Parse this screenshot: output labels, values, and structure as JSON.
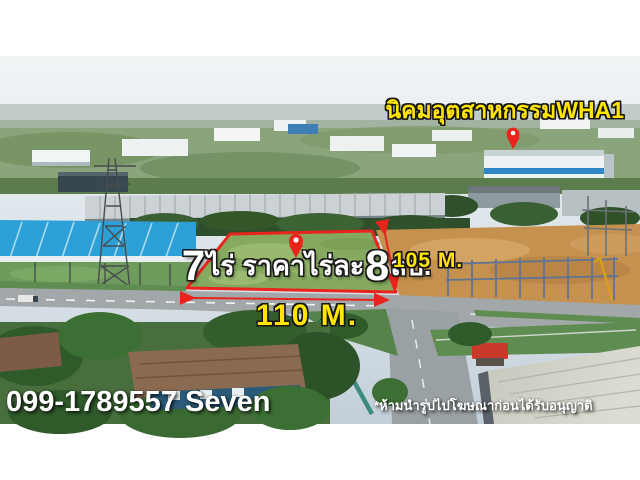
{
  "overlay": {
    "estate_label": "นิคมอุตสาหกรรมWHA1",
    "plot": {
      "area_number": "7",
      "area_text": "ไร่ ราคาไร่ละ",
      "price_number": "8",
      "price_suffix": "ลบ."
    },
    "frontage_width": "110 M.",
    "side_depth": "105 M.",
    "phone": "099-1789557 Seven",
    "disclaimer": "*ห้ามนำรูปไปโฆษณาก่อนได้รับอนุญาติ"
  },
  "icons": {
    "plot_pin": "map-pin-icon",
    "estate_pin": "map-pin-icon"
  },
  "colors": {
    "annotation_red": "#ea231d",
    "label_yellow": "#ffe404",
    "text_white": "#ffffff"
  }
}
